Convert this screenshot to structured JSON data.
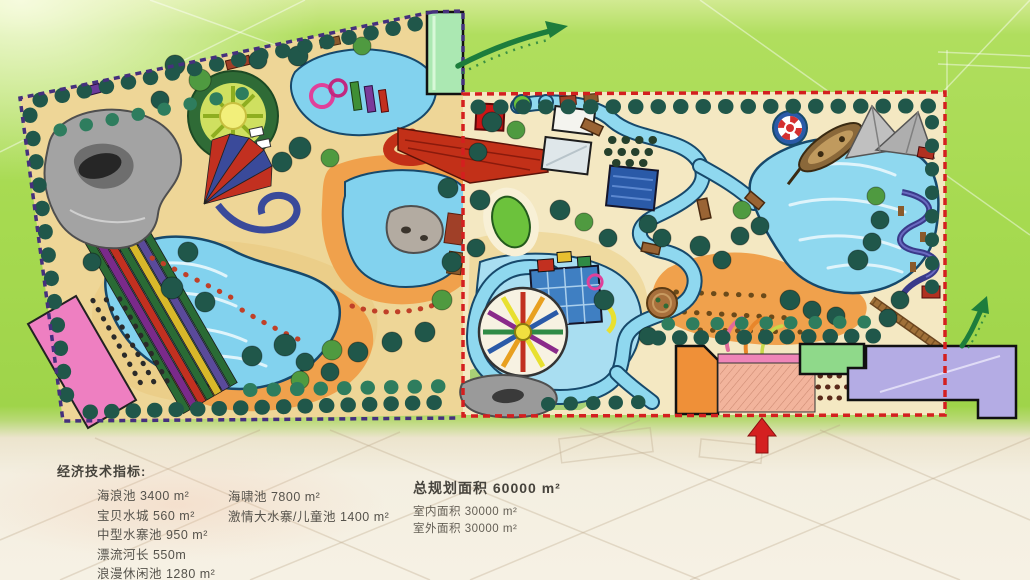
{
  "legend": {
    "title": "经济技术指标:",
    "col1": [
      "海浪池 3400 m²",
      "宝贝水城 560 m²",
      "中型水寨池 950 m²",
      "漂流河长 550m",
      "浪漫休闲池 1280 m²"
    ],
    "col2": [
      "海啸池 7800 m²",
      "激情大水寨/儿童池 1400 m²"
    ],
    "col3_primary": "总规划面积 60000 m²",
    "col3_secondary": [
      "室内面积 30000 m²",
      "室外面积 30000 m²"
    ]
  },
  "map": {
    "zone_border_colors": {
      "west_zone": "#45307d",
      "east_zone": "#d41f1f"
    },
    "accent_colors": {
      "water": "#82d2ee",
      "sand": "#eed697",
      "beach": "#f0a14c",
      "tree": "#20574a",
      "exit_arrow": "#1d7d3c",
      "entrance_arrow": "#d42020"
    },
    "features": [
      "rock-cave-mountain",
      "wave-pool",
      "racing-slides",
      "pink-building",
      "sun-plaza",
      "circus-tent-slide",
      "upper-play-pool",
      "lagoon-rock-island",
      "entrance-building",
      "red-slide-complex",
      "lazy-river",
      "kids-water-wheel",
      "kids-play-structure",
      "kids-rock",
      "tsunami-pool",
      "pirate-ship",
      "sail-canopies",
      "life-ring",
      "beach",
      "spa-pool",
      "slide-loops",
      "boardwalk",
      "orange-building",
      "hatched-plaza",
      "green-building",
      "purple-building"
    ]
  }
}
